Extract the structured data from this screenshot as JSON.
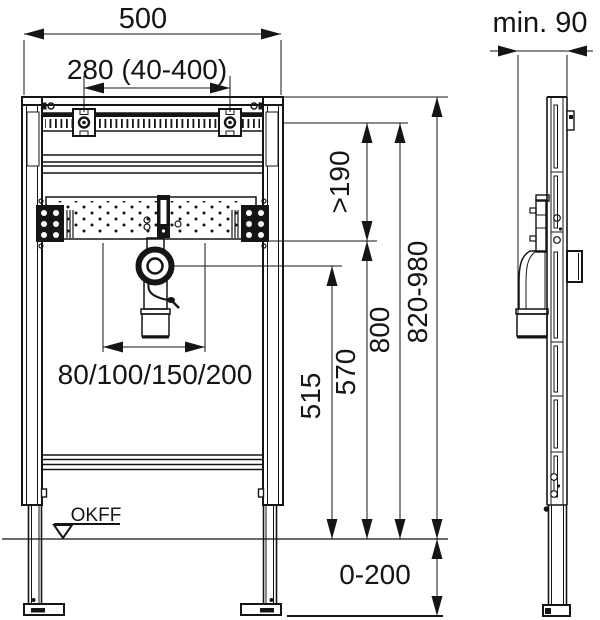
{
  "labels": {
    "width_total": "500",
    "fixing_range": "280 (40-400)",
    "depth_min": "min. 90",
    "clearance_min": ">190",
    "height_rail": "800",
    "height_frame": "820-980",
    "height_trap": "570",
    "height_outlet": "515",
    "drain_offsets": "80/100/150/200",
    "floor_level": "OKFF",
    "leg_range": "0-200"
  },
  "colors": {
    "line": "#151515",
    "background": "#ffffff"
  }
}
